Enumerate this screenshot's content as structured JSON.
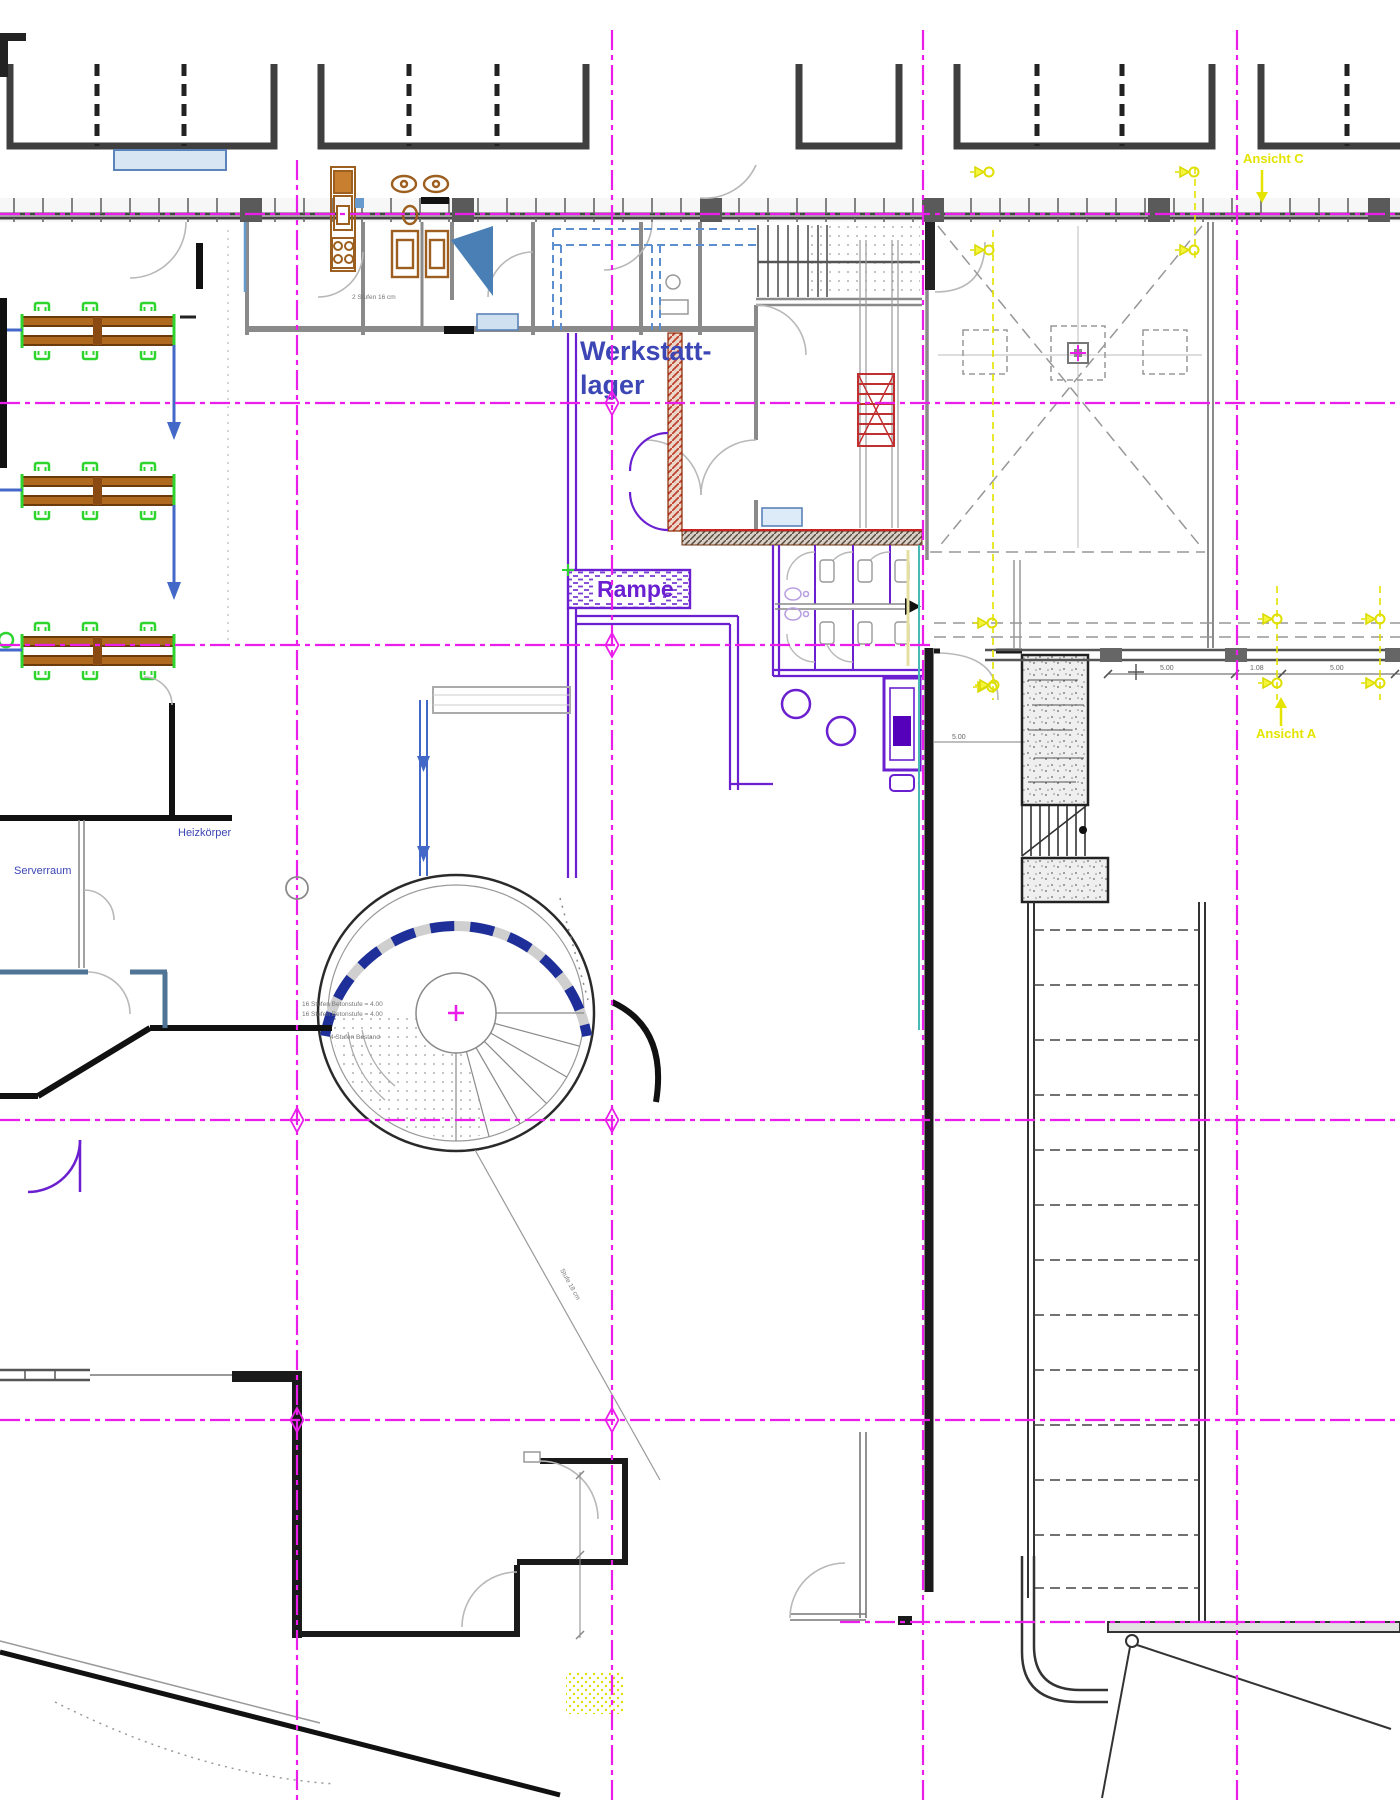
{
  "drawing": {
    "kind": "architectural-floor-plan",
    "labels": {
      "werkstattlager_line1": "Werkstatt-",
      "werkstattlager_line2": "lager",
      "rampe": "Rampe",
      "serverraum": "Serverraum",
      "heizkoerper": "Heizkörper",
      "ansicht_a": "Ansicht A",
      "ansicht_c": "Ansicht C"
    },
    "stair_notes": {
      "line1": "16 Stufen Betonstufe = 4.00",
      "line2": "16 Stufen Betonstufe = 4.00",
      "line3": "4 Stufen Bestand",
      "diagonal_note": "Stufe 18 cm",
      "kitchen_note": "2 Stufen 16 cm"
    },
    "dimensions": {
      "d1": "5.00",
      "d2": "1.08",
      "d3": "5.00",
      "d4": "5.00",
      "d5": "3.00"
    },
    "colors": {
      "grid_magenta": "#ea1dea",
      "wall_purple": "#6a1fd0",
      "arrow_blue": "#4468c8",
      "label_blue": "#3c46b4",
      "annotation_yellow": "#e4e400",
      "hatch_red": "#c04030",
      "bench_brown": "#b06a1f",
      "chair_green": "#2fd42f",
      "teal": "#49b8b8",
      "wall_black": "#1a1a1a"
    }
  }
}
